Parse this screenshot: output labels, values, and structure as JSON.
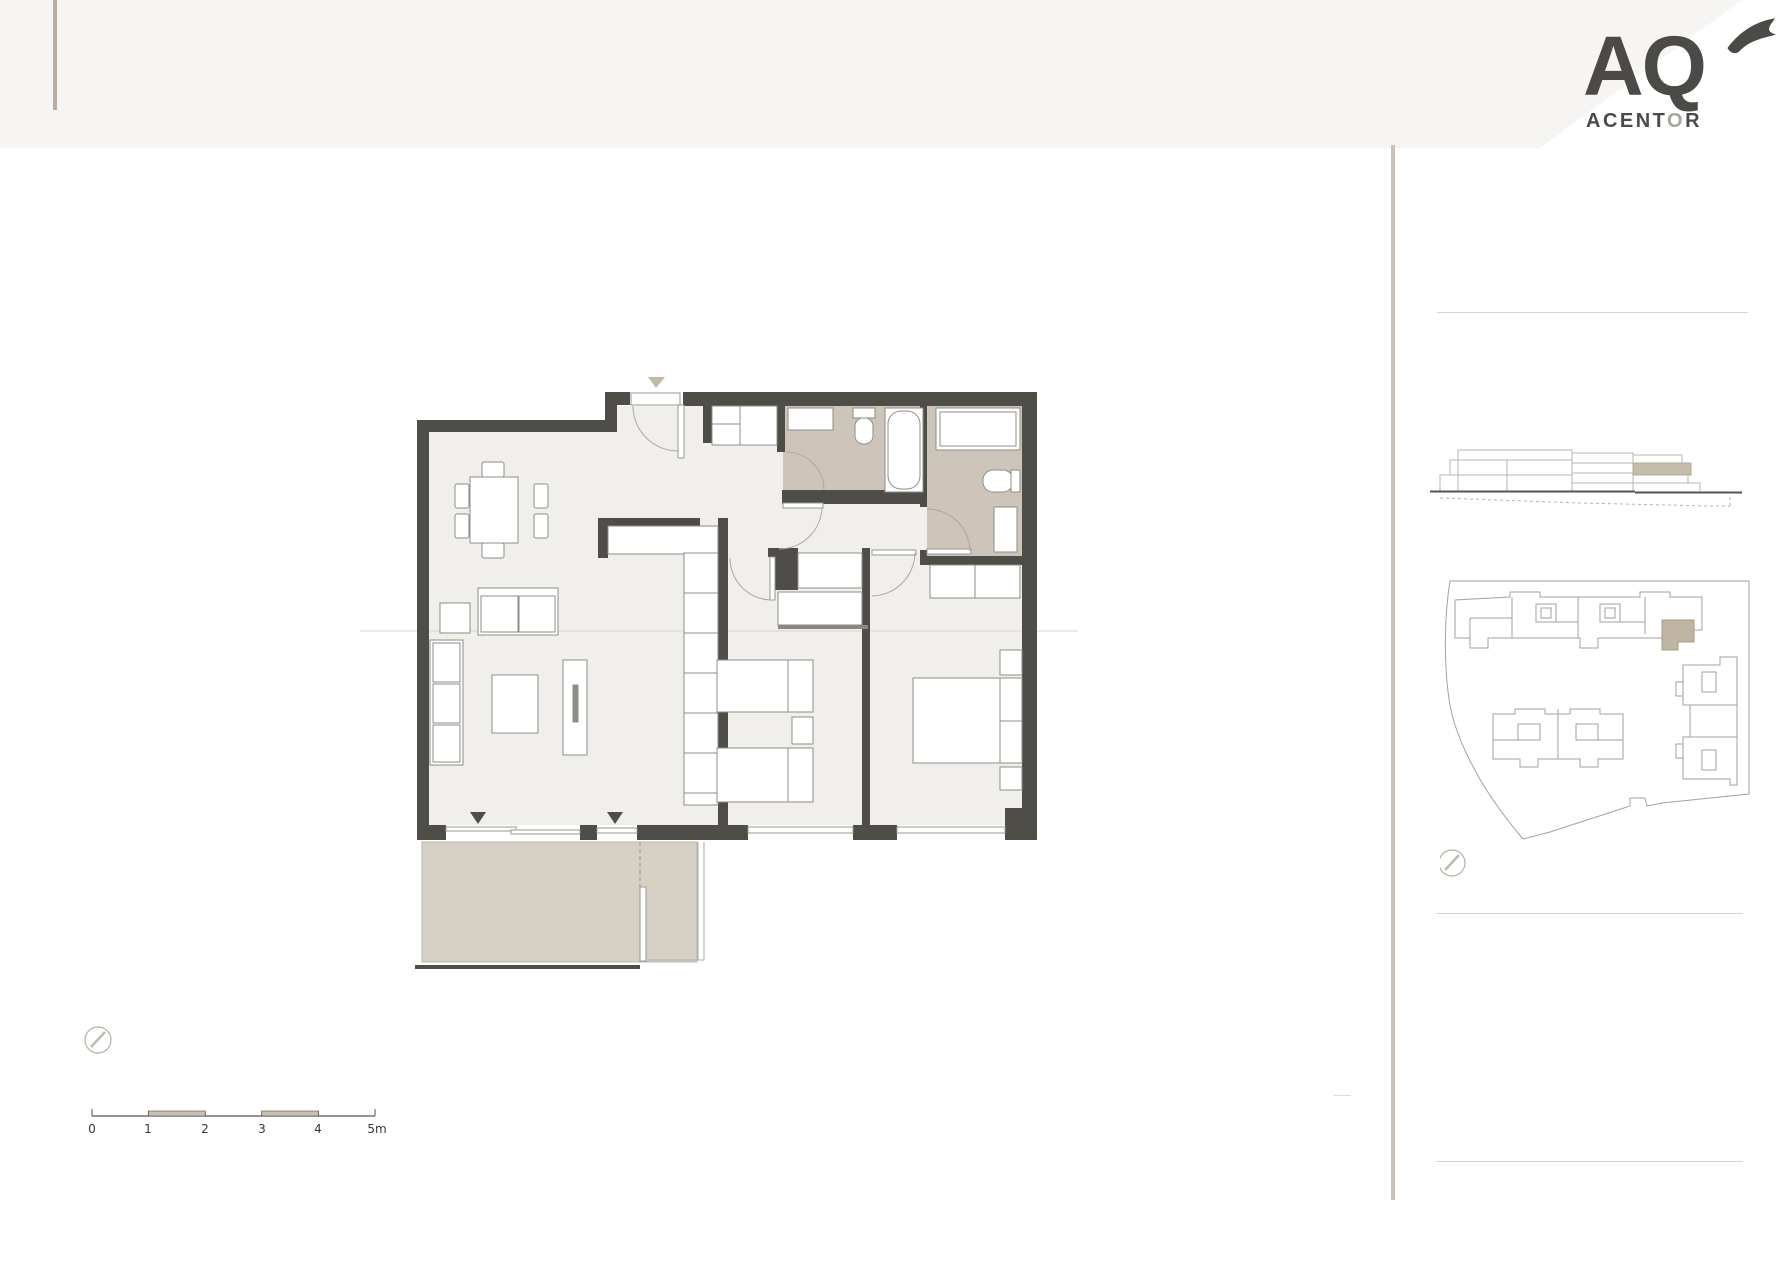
{
  "brand": {
    "logo": "AQ",
    "sub_part1": "ACENT",
    "sub_part2": "O",
    "sub_part3": "R"
  },
  "scale_bar": {
    "unit_labels": [
      "0",
      "1",
      "2",
      "3",
      "4",
      "5m"
    ]
  },
  "colors": {
    "header_band": "#f6f5f3",
    "wall": "#4e4d48",
    "room_floor": "#f0efec",
    "bath_floor": "#cdc5b9",
    "terrace_floor": "#d7d1c5",
    "accent_beige": "#c0b5a3",
    "line_gray": "#9a978f",
    "divider_beige": "#cac1b7",
    "logo_dark": "#4b4a46",
    "logo_light": "#a8a49e"
  }
}
